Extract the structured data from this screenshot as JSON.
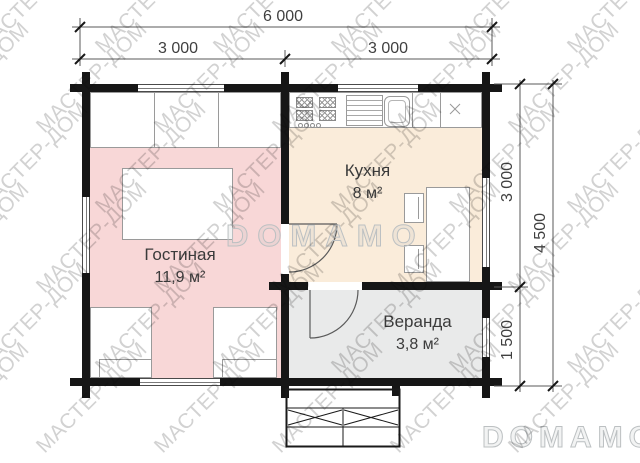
{
  "plan": {
    "dimensions": {
      "width_total": "6 000",
      "width_left": "3 000",
      "width_right": "3 000",
      "height_top": "3 000",
      "height_bottom": "1 500",
      "height_total": "4 500"
    },
    "rooms": [
      {
        "name": "Гостиная",
        "area": "11,9 м²",
        "floor_color": "#f8d7d7"
      },
      {
        "name": "Кухня",
        "area": "8 м²",
        "floor_color": "#faecda"
      },
      {
        "name": "Веранда",
        "area": "3,8 м²",
        "floor_color": "#e9eaea"
      }
    ]
  },
  "watermarks": {
    "brand": "МАСТЕР-ДОМ",
    "logo": "DOMAMO"
  }
}
